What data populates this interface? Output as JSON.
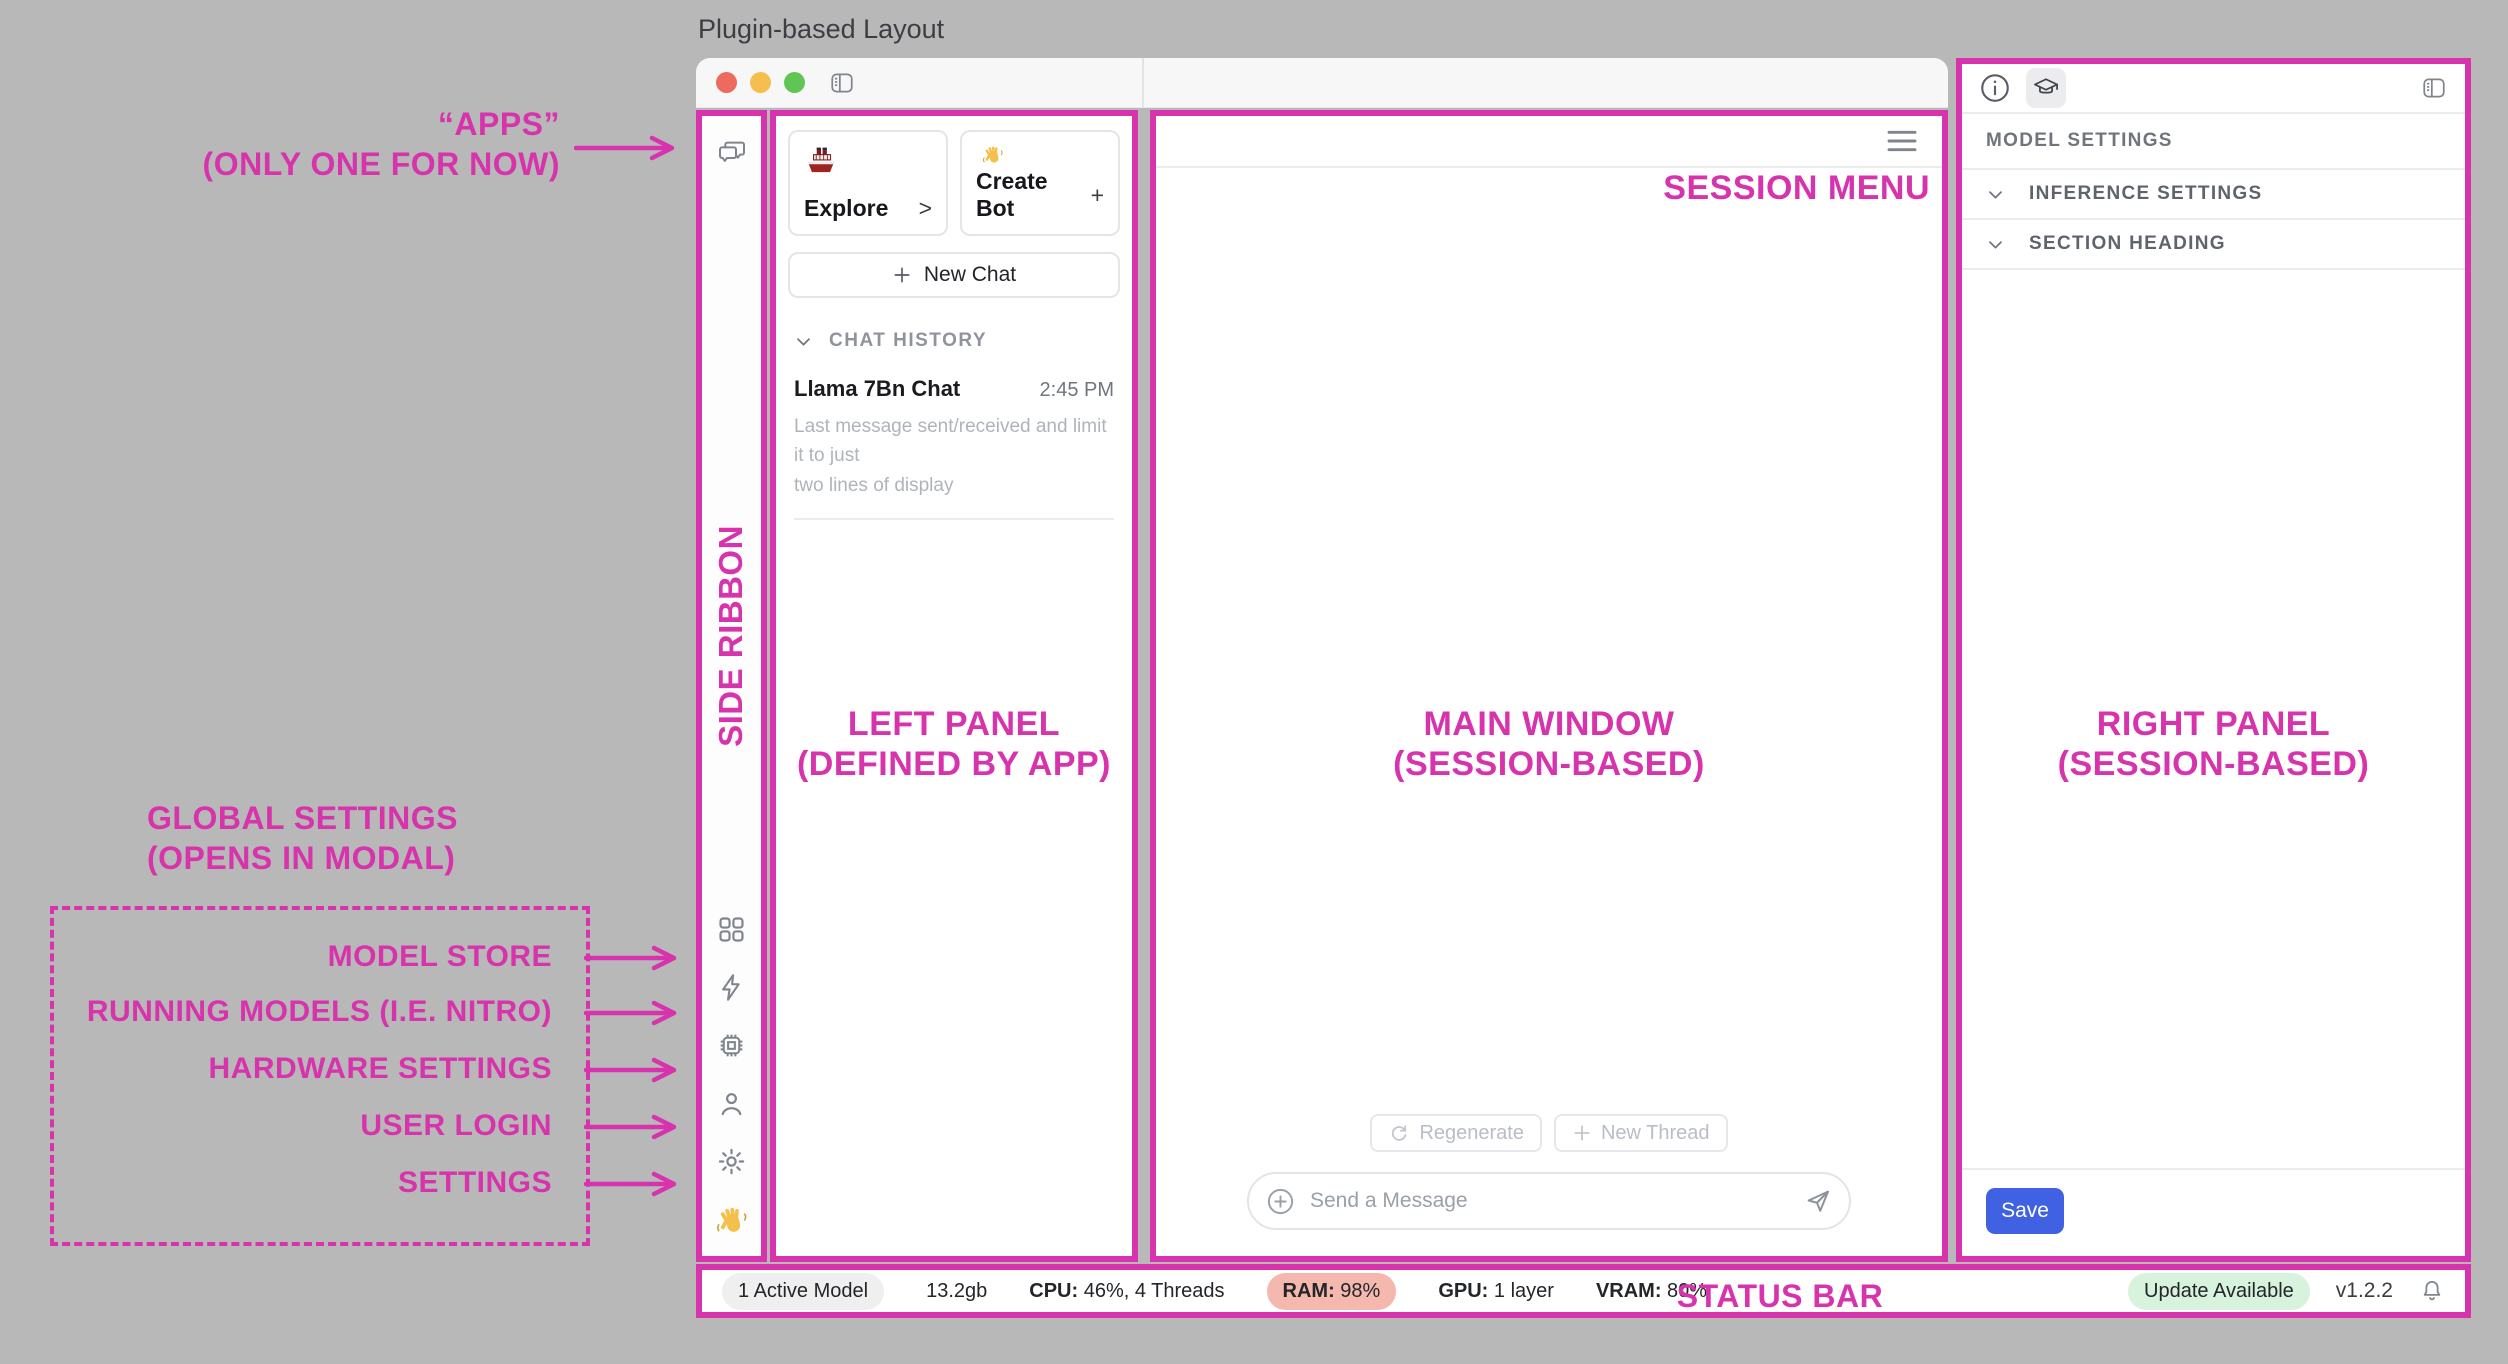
{
  "page_title": "Plugin-based Layout",
  "colors": {
    "annotation_pink": "#D733AC",
    "save_button_blue": "#4062E2",
    "ram_pill": "#F5B8AF",
    "update_pill": "#D7F2DD",
    "traffic_red": "#EC6A5E",
    "traffic_yellow": "#F5BF4F",
    "traffic_green": "#61C554"
  },
  "annotations": {
    "apps_line1": "“APPS”",
    "apps_line2": "(ONLY ONE FOR NOW)",
    "side_ribbon": "SIDE RIBBON",
    "left_panel_line1": "LEFT PANEL",
    "left_panel_line2": "(DEFINED BY APP)",
    "main_window_line1": "MAIN WINDOW",
    "main_window_line2": "(SESSION-BASED)",
    "right_panel_line1": "RIGHT PANEL",
    "right_panel_line2": "(SESSION-BASED)",
    "session_menu": "SESSION MENU",
    "status_bar": "STATUS BAR",
    "global_settings_line1": "GLOBAL SETTINGS",
    "global_settings_line2": "(OPENS IN MODAL)",
    "global_items": [
      "MODEL STORE",
      "RUNNING MODELS (I.E. NITRO)",
      "HARDWARE SETTINGS",
      "USER LOGIN",
      "SETTINGS"
    ]
  },
  "left_panel": {
    "cards": [
      {
        "label": "Explore",
        "affix": ">",
        "icon": "ship-icon"
      },
      {
        "label": "Create Bot",
        "affix": "+",
        "icon": "waving-hand-icon"
      }
    ],
    "new_chat_label": "New Chat",
    "chat_history": {
      "header": "CHAT HISTORY",
      "items": [
        {
          "title": "Llama 7Bn Chat",
          "time": "2:45 PM",
          "preview_line1": "Last message sent/received and limit it to just",
          "preview_line2": "two lines of display"
        }
      ]
    }
  },
  "main_window": {
    "regenerate_label": "Regenerate",
    "new_thread_label": "New Thread",
    "message_placeholder": "Send a Message"
  },
  "right_panel": {
    "header": "MODEL SETTINGS",
    "sections": [
      {
        "label": "INFERENCE SETTINGS"
      },
      {
        "label": "SECTION HEADING"
      }
    ],
    "save_label": "Save"
  },
  "status_bar": {
    "active_model": "1 Active Model",
    "memory": "13.2gb",
    "cpu_label": "CPU:",
    "cpu_value": " 46%, 4 Threads",
    "ram_label": "RAM:",
    "ram_value": " 98%",
    "gpu_label": "GPU:",
    "gpu_value": " 1 layer",
    "vram_label": "VRAM:",
    "vram_value": " 80%",
    "update_badge": "Update Available",
    "version": "v1.2.2"
  }
}
